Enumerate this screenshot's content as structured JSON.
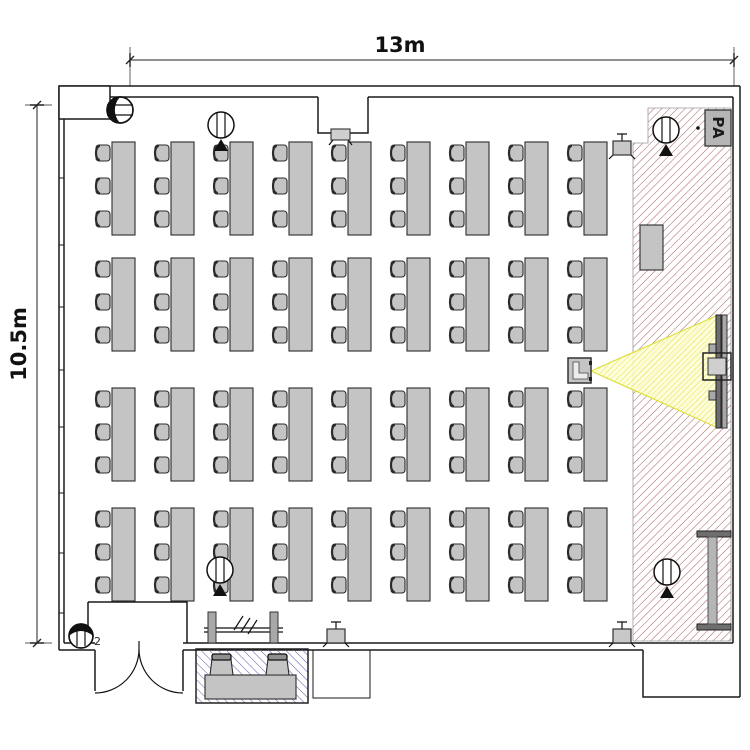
{
  "dimensions": {
    "width_label": "13m",
    "height_label": "10.5m"
  },
  "stage": {
    "pa_label": "PA"
  },
  "entrance": {
    "device_label": "2"
  },
  "desk_grid": {
    "rows": 4,
    "cols": 9,
    "chairs_per_desk": 3,
    "total_seats": 108,
    "col_start_x": 95,
    "col_pitch": 59,
    "row_tops": [
      142,
      258,
      388,
      508
    ],
    "chair_offsets": [
      3,
      36,
      69
    ],
    "chair_w": 17,
    "chair_h": 17,
    "table_w": 23,
    "table_h": 93
  },
  "ceiling_speakers": [
    {
      "cx": 221,
      "cy": 125
    },
    {
      "cx": 666,
      "cy": 130
    },
    {
      "cx": 220,
      "cy": 570
    },
    {
      "cx": 667,
      "cy": 572
    }
  ],
  "wall_fixtures": [
    {
      "x": 613,
      "y": 141
    },
    {
      "x": 327,
      "y": 629
    },
    {
      "x": 613,
      "y": 629
    }
  ],
  "window_tick_ys": [
    178,
    245,
    307,
    370,
    427,
    493,
    553,
    613
  ],
  "reception": {
    "chair_xs": [
      210,
      266
    ],
    "chair_y": 654
  },
  "colors": {
    "furniture": "#c4c4c4",
    "outline": "#2b2b2b",
    "wall": "#1a1a1a",
    "dim": "#222222",
    "stage_hatch": "#a86060",
    "reception_hatch": "#5d5db0",
    "cone_line": "#e0e04a",
    "cone_fill": "#ffffd6",
    "pa_box": "#b5b5b5"
  }
}
